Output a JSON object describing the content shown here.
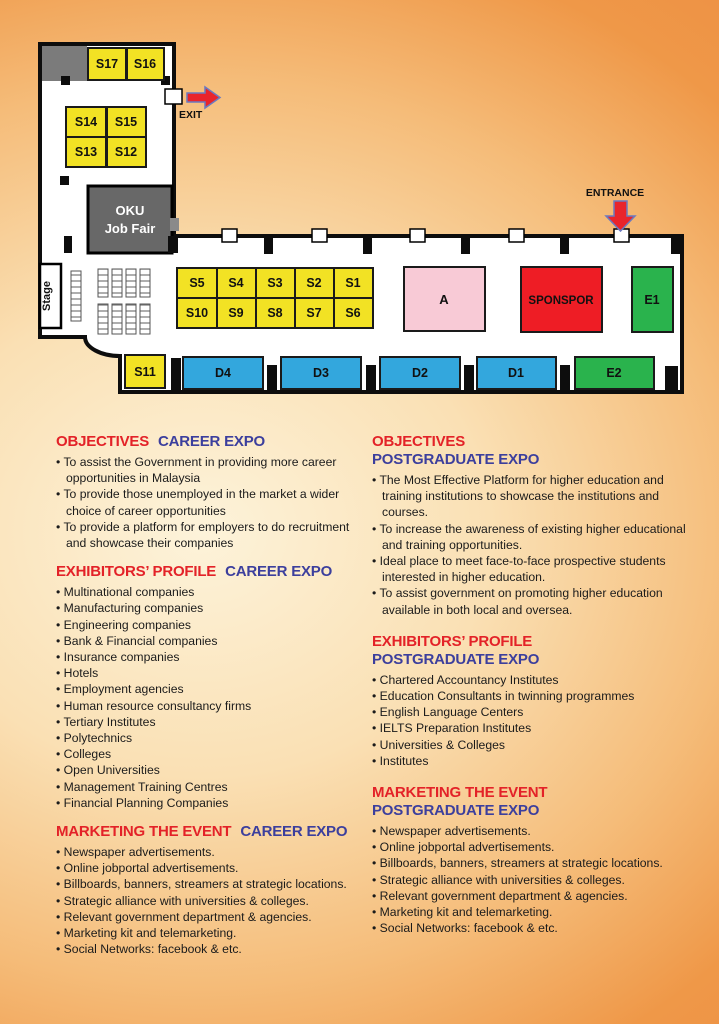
{
  "colors": {
    "background_orange": "#ee9245",
    "background_cream": "#fdf3da",
    "wall": "#0d0d0d",
    "booth_yellow": "#f2e224",
    "booth_blue": "#33a7dd",
    "booth_green": "#2ab34d",
    "booth_pink": "#f8cad6",
    "booth_red": "#ee1d25",
    "gray_block": "#7b7b7b",
    "heading_red": "#e32228",
    "heading_blue": "#3c3f9d",
    "arrow_red": "#e9242b"
  },
  "floorplan": {
    "exit_label": "EXIT",
    "entrance_label": "ENTRANCE",
    "stage_label": "Stage",
    "oku_line1": "OKU",
    "oku_line2": "Job Fair",
    "booths": {
      "s1": "S1",
      "s2": "S2",
      "s3": "S3",
      "s4": "S4",
      "s5": "S5",
      "s6": "S6",
      "s7": "S7",
      "s8": "S8",
      "s9": "S9",
      "s10": "S10",
      "s11": "S11",
      "s12": "S12",
      "s13": "S13",
      "s14": "S14",
      "s15": "S15",
      "s16": "S16",
      "s17": "S17",
      "d1": "D1",
      "d2": "D2",
      "d3": "D3",
      "d4": "D4",
      "e1": "E1",
      "e2": "E2",
      "a": "A",
      "sponsor": "SPONSPOR"
    }
  },
  "columns": {
    "left": [
      {
        "heading_red": "OBJECTIVES",
        "heading_blue": "CAREER EXPO",
        "items": [
          "To assist the Government in providing more career opportunities in Malaysia",
          "To provide those unemployed in the market a wider choice of career opportunities",
          "To provide a platform for employers to do recruitment and showcase their companies"
        ]
      },
      {
        "heading_red": "EXHIBITORS’ PROFILE",
        "heading_blue": "CAREER EXPO",
        "items": [
          "Multinational companies",
          "Manufacturing companies",
          "Engineering companies",
          "Bank & Financial companies",
          "Insurance companies",
          "Hotels",
          "Employment agencies",
          "Human resource consultancy firms",
          "Tertiary Institutes",
          "Polytechnics",
          "Colleges",
          "Open Universities",
          "Management Training Centres",
          "Financial Planning Companies"
        ]
      },
      {
        "heading_red": "MARKETING THE EVENT",
        "heading_blue": "CAREER EXPO",
        "items": [
          "Newspaper advertisements.",
          "Online jobportal advertisements.",
          "Billboards, banners, streamers at strategic locations.",
          "Strategic alliance with universities & colleges.",
          "Relevant government department & agencies.",
          "Marketing kit and telemarketing.",
          "Social Networks: facebook & etc."
        ]
      }
    ],
    "right": [
      {
        "heading_red": "OBJECTIVES",
        "heading_blue": "POSTGRADUATE EXPO",
        "items": [
          "The Most Effective Platform for higher education and training institutions to showcase the institutions and courses.",
          "To increase the awareness of existing higher educational and training opportunities.",
          "Ideal place to meet face-to-face prospective students interested in higher education.",
          "To assist government on promoting higher education available in both local and oversea."
        ]
      },
      {
        "heading_red": "EXHIBITORS’ PROFILE",
        "heading_blue": "POSTGRADUATE EXPO",
        "items": [
          "Chartered Accountancy Institutes",
          "Education Consultants in twinning programmes",
          "English Language Centers",
          "IELTS Preparation Institutes",
          "Universities & Colleges",
          "Institutes"
        ]
      },
      {
        "heading_red": "MARKETING THE EVENT",
        "heading_blue": "POSTGRADUATE EXPO",
        "items": [
          "Newspaper advertisements.",
          "Online jobportal advertisements.",
          "Billboards, banners, streamers at strategic locations.",
          "Strategic alliance with universities & colleges.",
          "Relevant government department & agencies.",
          "Marketing kit and telemarketing.",
          "Social Networks: facebook & etc."
        ]
      }
    ]
  }
}
